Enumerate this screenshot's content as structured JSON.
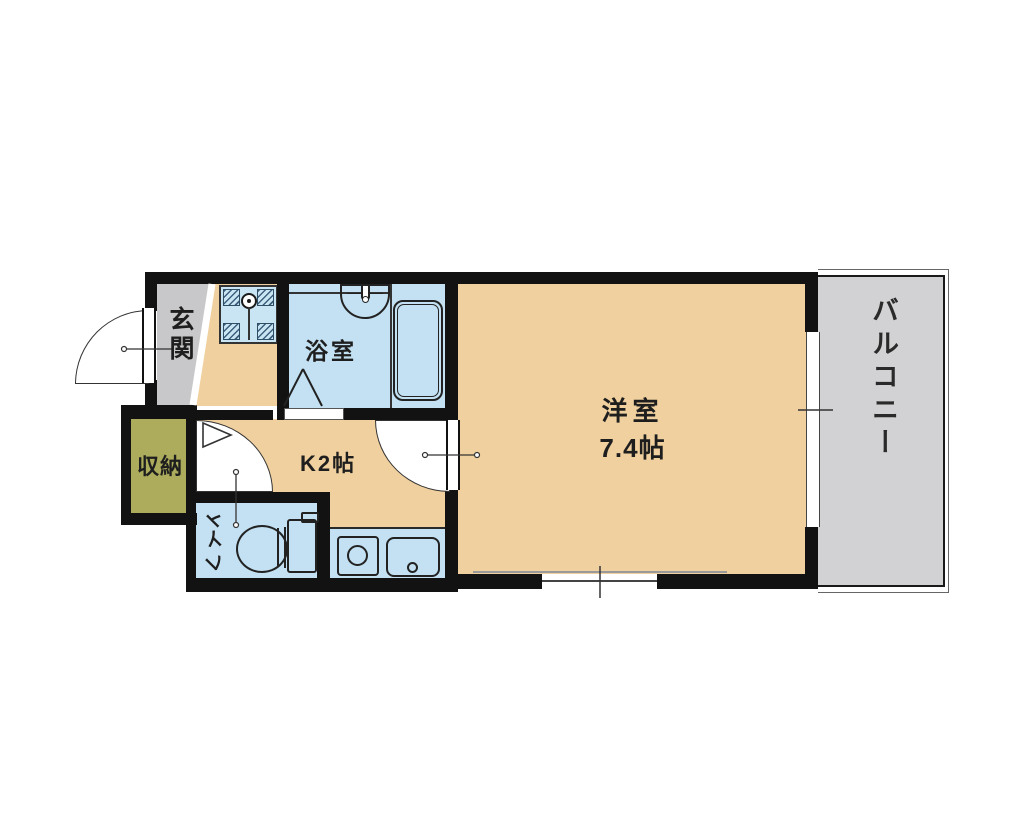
{
  "floor_plan": {
    "rooms": {
      "entrance": {
        "label": "玄関"
      },
      "bathroom": {
        "label": "浴室"
      },
      "kitchen": {
        "label": "K2帖"
      },
      "western_room": {
        "label": "洋室",
        "size": "7.4帖"
      },
      "balcony": {
        "label": "バルコニー"
      },
      "storage": {
        "label": "収納"
      },
      "toilet": {
        "label": "トイレ",
        "chars": [
          "ト",
          "イ",
          "レ"
        ]
      }
    },
    "colors": {
      "floor": "#F0D09E",
      "wet_area": "#C3E1F2",
      "washer_pan": "#C9E5F3",
      "entrance_gray": "#C8C8CA",
      "balcony_gray": "#D2D2D4",
      "storage_olive": "#ADAC5C",
      "wall": "#121212"
    }
  }
}
